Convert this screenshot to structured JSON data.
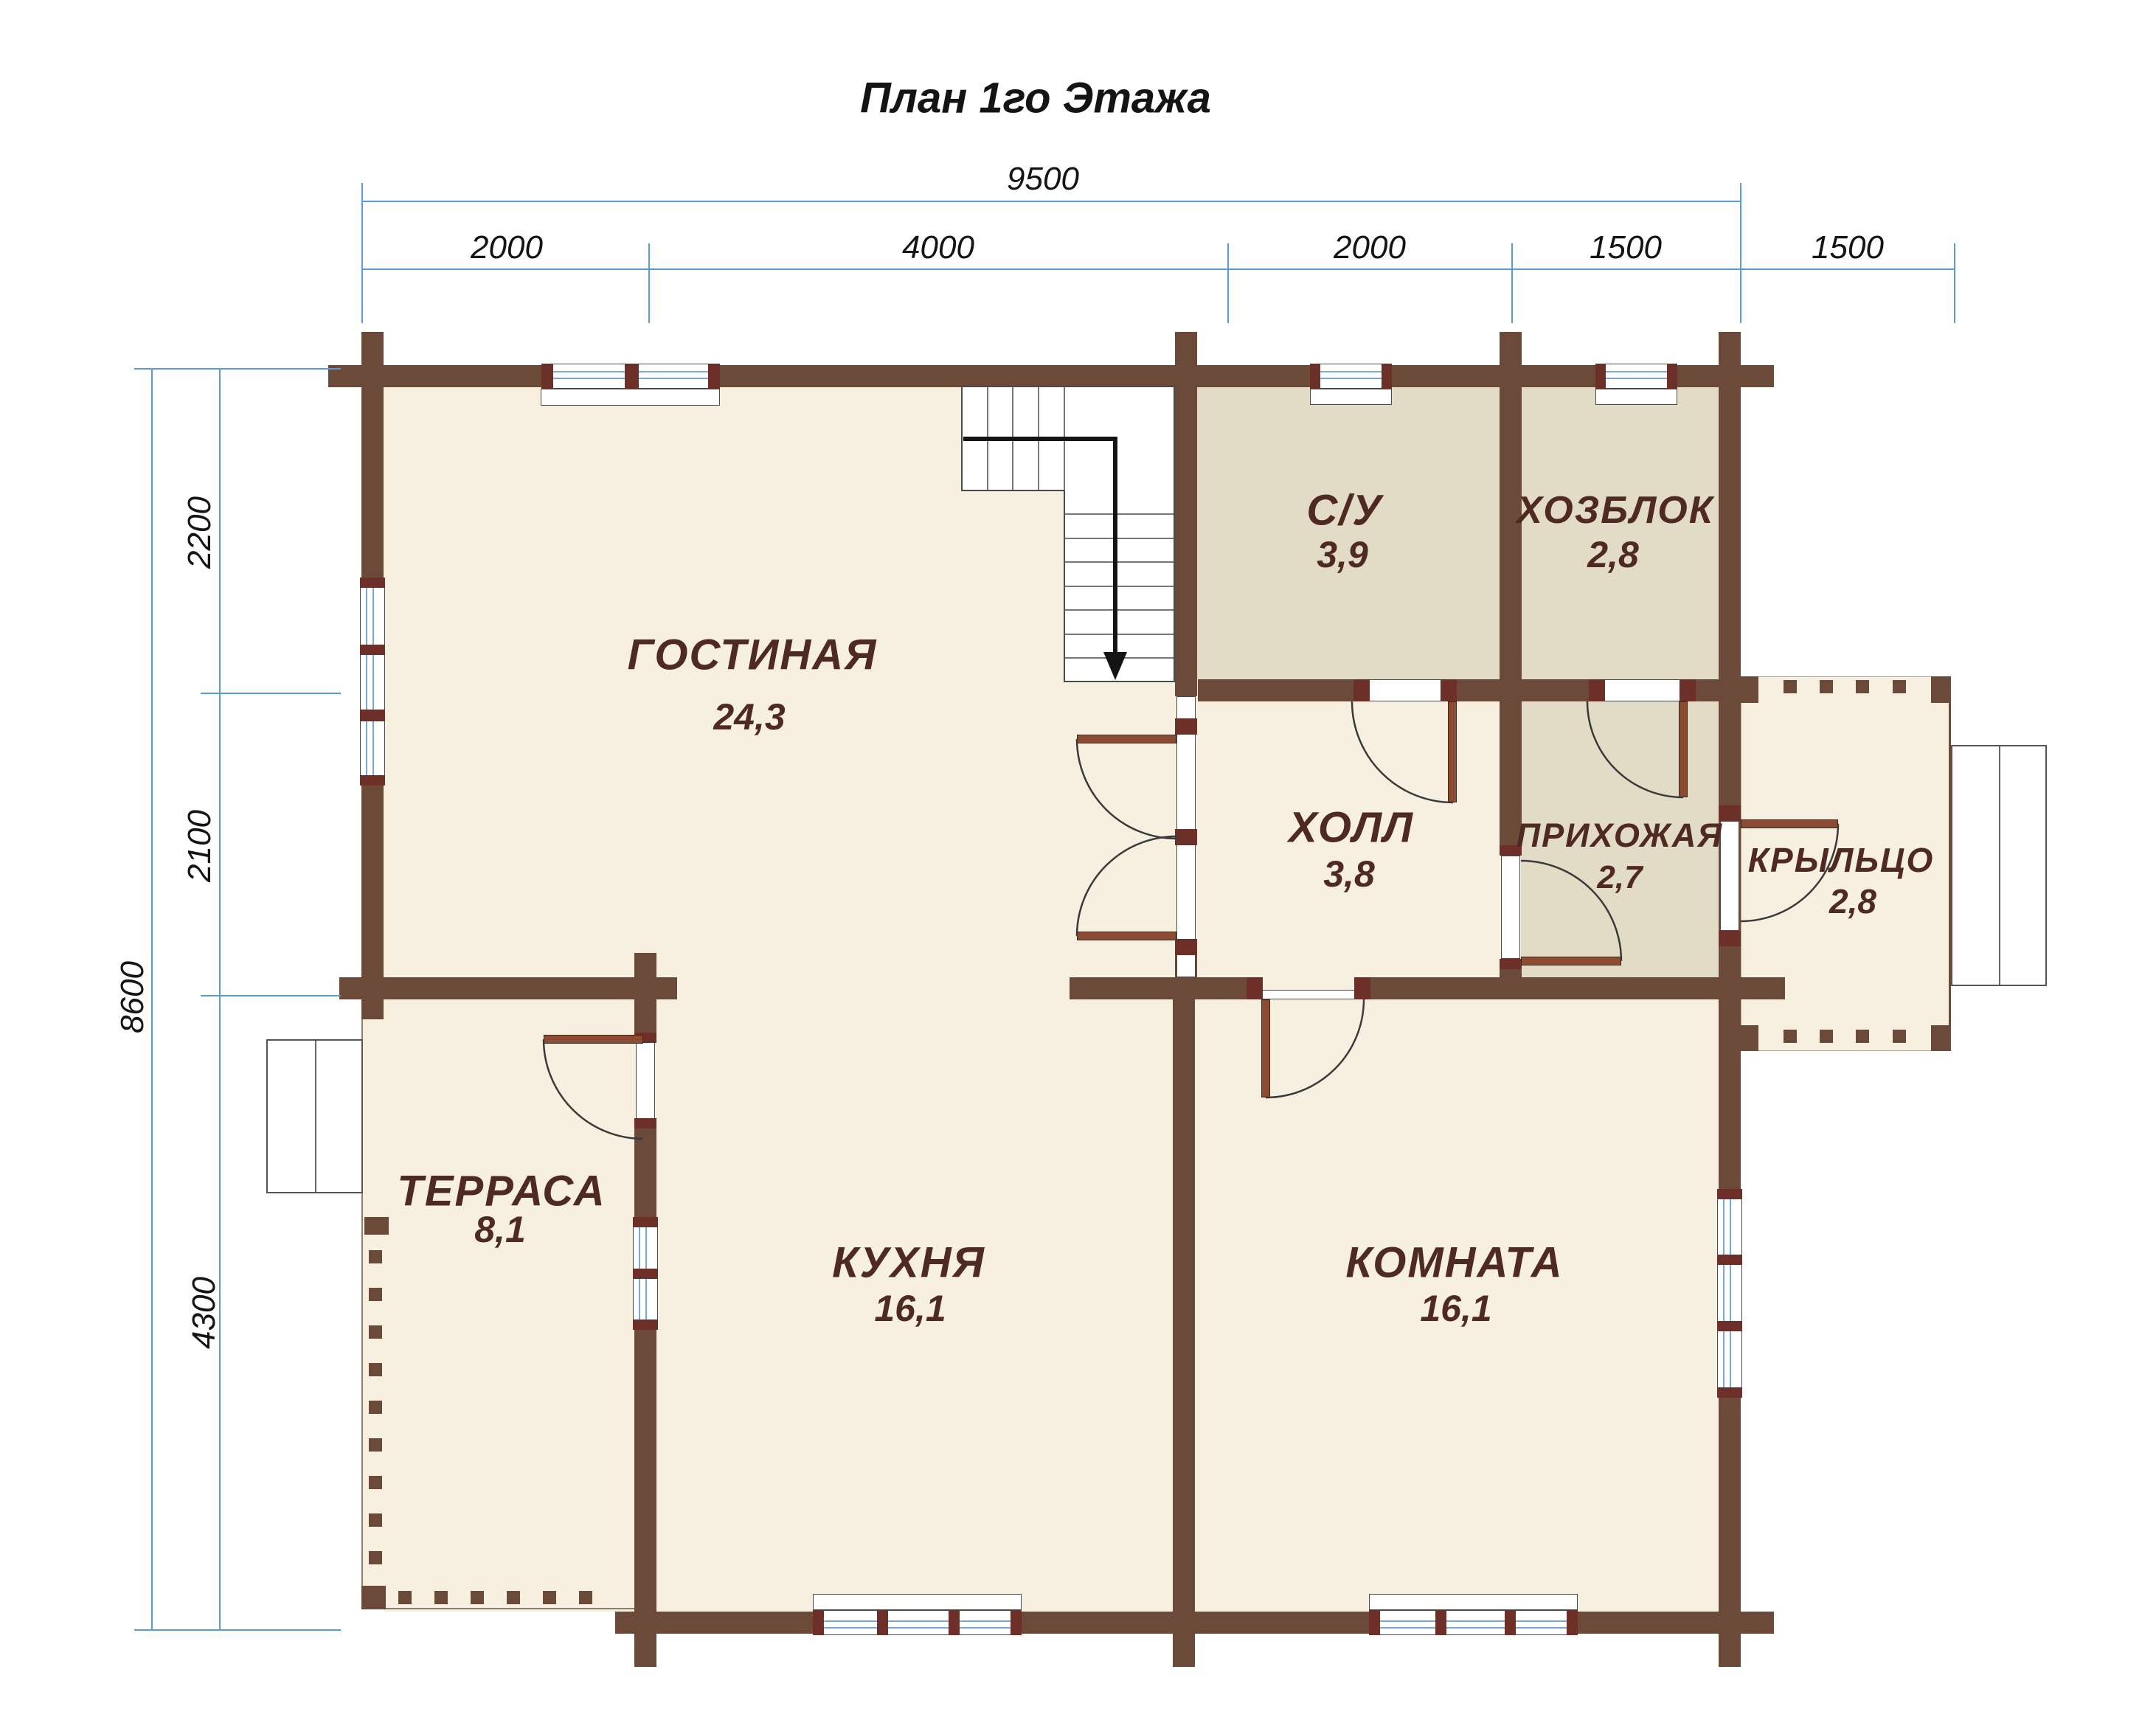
{
  "title": "План 1го Этажа",
  "colors": {
    "wall": "#6b4a39",
    "door": "#8c4c33",
    "block": "#6d3028",
    "glass": "#7ba6d6",
    "cream": "#f7f0e0",
    "dark": "#e2dbc6",
    "label": "#4f2a23",
    "dim": "#5b9bd5"
  },
  "dimensions": {
    "top": {
      "total": "9500",
      "segments": [
        "2000",
        "4000",
        "2000",
        "1500"
      ],
      "porch": "1500"
    },
    "left": {
      "total": "8600",
      "segments": [
        "2200",
        "2100",
        "4300"
      ]
    }
  },
  "rooms": {
    "living": {
      "name": "ГОСТИНАЯ",
      "area": "24,3"
    },
    "wc": {
      "name": "С/У",
      "area": "3,9"
    },
    "utility": {
      "name": "ХОЗБЛОК",
      "area": "2,8"
    },
    "hall": {
      "name": "ХОЛЛ",
      "area": "3,8"
    },
    "entry": {
      "name": "ПРИХОЖАЯ",
      "area": "2,7"
    },
    "porch": {
      "name": "КРЫЛЬЦО",
      "area": "2,8"
    },
    "terrace": {
      "name": "ТЕРРАСА",
      "area": "8,1"
    },
    "kitchen": {
      "name": "КУХНЯ",
      "area": "16,1"
    },
    "room": {
      "name": "КОМНАТА",
      "area": "16,1"
    }
  }
}
